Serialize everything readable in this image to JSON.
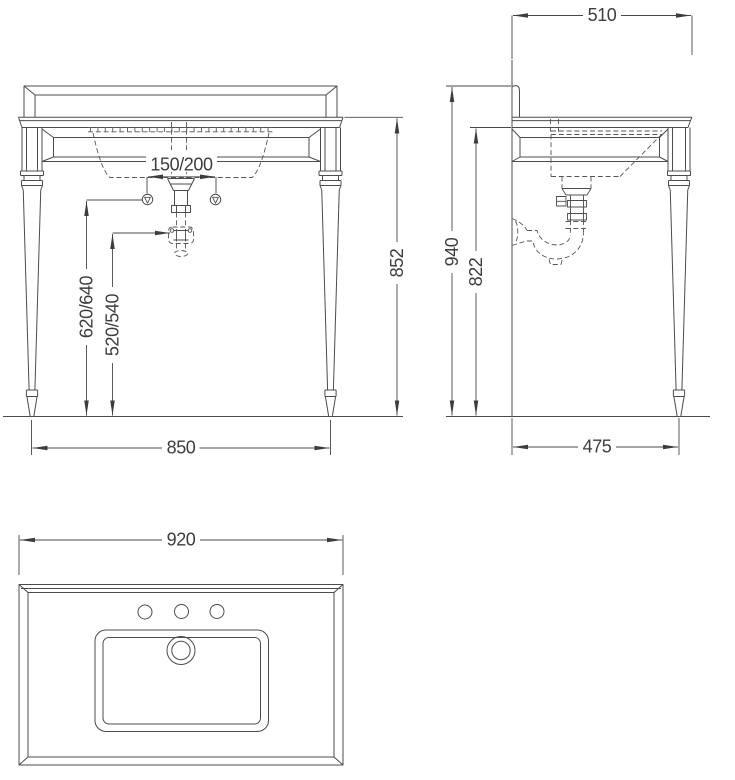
{
  "drawing": {
    "front_view": {
      "width": "850",
      "height": "852",
      "tap_centres": "150/200",
      "supply_height": "620/640",
      "waste_height": "520/540"
    },
    "side_view": {
      "depth": "510",
      "overall_height": "940",
      "underside_height": "822",
      "floor_depth": "475"
    },
    "top_view": {
      "width": "920"
    }
  }
}
